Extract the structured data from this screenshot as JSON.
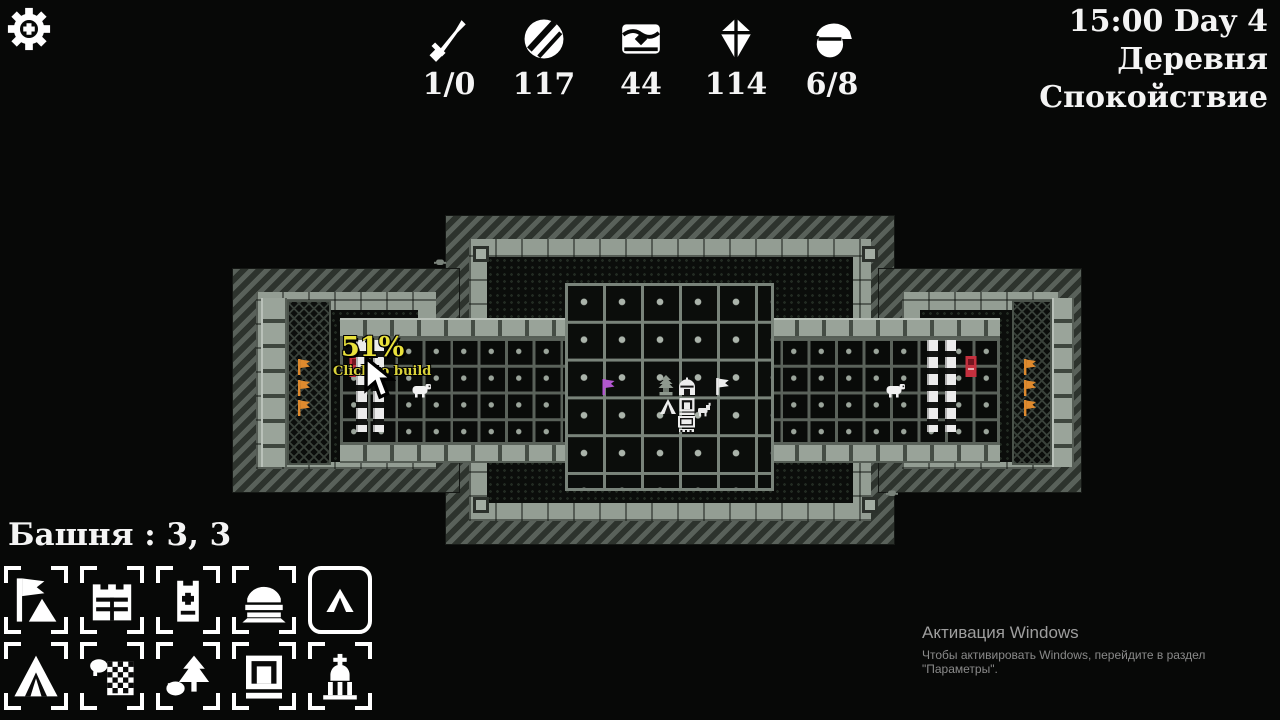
{
  "hud": {
    "clock": "15:00 Day 4",
    "location": "Деревня",
    "mood": "Спокойствие",
    "resources": [
      {
        "icon": "sword-icon",
        "value": "1/0"
      },
      {
        "icon": "coin-icon",
        "value": "117"
      },
      {
        "icon": "chest-icon",
        "value": "44"
      },
      {
        "icon": "book-icon",
        "value": "114"
      },
      {
        "icon": "population-icon",
        "value": "6/8"
      }
    ]
  },
  "selection_bar": {
    "text": "Башня :  3,  3"
  },
  "tooltip": {
    "progress": "51%",
    "hint": "Click to build"
  },
  "build_menu": {
    "items": [
      {
        "name": "banner",
        "selected": false
      },
      {
        "name": "gate",
        "selected": false
      },
      {
        "name": "watchtower",
        "selected": false
      },
      {
        "name": "yurt",
        "selected": false
      },
      {
        "name": "tent",
        "selected": true
      },
      {
        "name": "big-tent",
        "selected": false
      },
      {
        "name": "farm",
        "selected": false
      },
      {
        "name": "grove",
        "selected": false
      },
      {
        "name": "arch-house",
        "selected": false
      },
      {
        "name": "church",
        "selected": false
      }
    ]
  },
  "map": {
    "colors": {
      "orange": "#df8a2e",
      "purple": "#b257cf",
      "white": "#ececec",
      "red": "#c5303e"
    },
    "sprites": [
      {
        "type": "orange-flag",
        "x": 296,
        "y": 358,
        "w": 16,
        "h": 18,
        "color": "#df8a2e"
      },
      {
        "type": "orange-flag",
        "x": 296,
        "y": 379,
        "w": 16,
        "h": 18,
        "color": "#df8a2e"
      },
      {
        "type": "orange-flag",
        "x": 296,
        "y": 399,
        "w": 16,
        "h": 18,
        "color": "#df8a2e"
      },
      {
        "type": "orange-flag",
        "x": 1022,
        "y": 358,
        "w": 16,
        "h": 18,
        "color": "#df8a2e"
      },
      {
        "type": "orange-flag",
        "x": 1022,
        "y": 379,
        "w": 16,
        "h": 18,
        "color": "#df8a2e"
      },
      {
        "type": "orange-flag",
        "x": 1022,
        "y": 399,
        "w": 16,
        "h": 18,
        "color": "#df8a2e"
      },
      {
        "type": "purple-flag",
        "x": 600,
        "y": 378,
        "w": 17,
        "h": 18,
        "color": "#b257cf"
      },
      {
        "type": "white-flag",
        "x": 714,
        "y": 377,
        "w": 17,
        "h": 19,
        "color": "#ececec"
      },
      {
        "type": "statue-tree",
        "x": 655,
        "y": 374,
        "w": 22,
        "h": 23
      },
      {
        "type": "dome-house",
        "x": 677,
        "y": 377,
        "w": 20,
        "h": 20
      },
      {
        "type": "tent-small",
        "x": 659,
        "y": 397,
        "w": 18,
        "h": 19
      },
      {
        "type": "arch-house-small",
        "x": 678,
        "y": 397,
        "w": 18,
        "h": 19
      },
      {
        "type": "goat",
        "x": 697,
        "y": 402,
        "w": 15,
        "h": 15
      },
      {
        "type": "screen-house",
        "x": 677,
        "y": 415,
        "w": 19,
        "h": 18
      },
      {
        "type": "sheep",
        "x": 411,
        "y": 382,
        "w": 22,
        "h": 16
      },
      {
        "type": "sheep",
        "x": 885,
        "y": 382,
        "w": 22,
        "h": 16
      },
      {
        "type": "red-door",
        "x": 348,
        "y": 355,
        "w": 14,
        "h": 23,
        "color": "#c5303e"
      },
      {
        "type": "red-door",
        "x": 964,
        "y": 355,
        "w": 14,
        "h": 23,
        "color": "#c5303e"
      },
      {
        "type": "barricade",
        "x": 356,
        "y": 340,
        "w": 11,
        "h": 92
      },
      {
        "type": "barricade",
        "x": 373,
        "y": 340,
        "w": 11,
        "h": 92
      },
      {
        "type": "barricade",
        "x": 927,
        "y": 340,
        "w": 11,
        "h": 92
      },
      {
        "type": "barricade",
        "x": 945,
        "y": 340,
        "w": 11,
        "h": 92
      },
      {
        "type": "critter",
        "x": 434,
        "y": 258,
        "w": 12,
        "h": 9
      },
      {
        "type": "critter",
        "x": 886,
        "y": 489,
        "w": 12,
        "h": 9
      }
    ]
  },
  "watermark": {
    "line1": "Активация Windows",
    "line2": "Чтобы активировать Windows, перейдите в раздел \"Параметры\"."
  }
}
